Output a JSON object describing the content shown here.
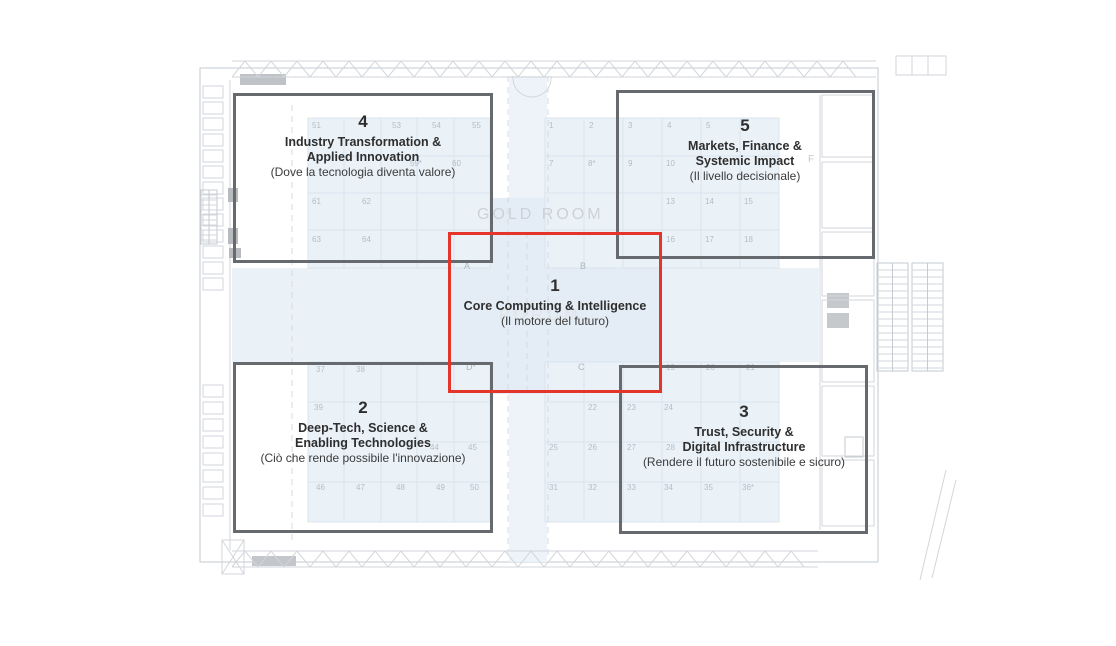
{
  "diagram_title": "Exhibition floor plan with thematic zones",
  "colors": {
    "zone_outline": "#66696d",
    "highlight_outline": "#e5352b",
    "booth_fill": "#eaf2f8",
    "corridor_fill": "#eaf1f7",
    "plan_line": "#d2d6db"
  },
  "zones": [
    {
      "number": "1",
      "line1": "Core Computing & Intelligence",
      "line2": "",
      "subtitle": "(Il motore del futuro)",
      "highlighted": true
    },
    {
      "number": "2",
      "line1": "Deep-Tech, Science &",
      "line2": "Enabling Technologies",
      "subtitle": "(Ciò che rende possibile l'innovazione)",
      "highlighted": false
    },
    {
      "number": "3",
      "line1": "Trust, Security &",
      "line2": "Digital Infrastructure",
      "subtitle": "(Rendere il futuro sostenibile e sicuro)",
      "highlighted": false
    },
    {
      "number": "4",
      "line1": "Industry Transformation &",
      "line2": "Applied Innovation",
      "subtitle": "(Dove la tecnologia diventa valore)",
      "highlighted": false
    },
    {
      "number": "5",
      "line1": "Markets, Finance &",
      "line2": "Systemic Impact",
      "subtitle": "(Il livello decisionale)",
      "highlighted": false
    }
  ],
  "plan": {
    "room_label": "GOLD ROOM",
    "forum_label": "FORUM",
    "area_label": "F",
    "hall_letters": [
      {
        "t": "A",
        "x": 464,
        "y": 262
      },
      {
        "t": "B",
        "x": 580,
        "y": 262
      },
      {
        "t": "D*",
        "x": 466,
        "y": 363
      },
      {
        "t": "C",
        "x": 578,
        "y": 363
      }
    ],
    "booth_numbers": [
      {
        "t": "51",
        "x": 312,
        "y": 122
      },
      {
        "t": "53",
        "x": 392,
        "y": 122
      },
      {
        "t": "54",
        "x": 432,
        "y": 122
      },
      {
        "t": "55",
        "x": 472,
        "y": 122
      },
      {
        "t": "59*",
        "x": 410,
        "y": 160
      },
      {
        "t": "60",
        "x": 452,
        "y": 160
      },
      {
        "t": "61",
        "x": 312,
        "y": 198
      },
      {
        "t": "62",
        "x": 362,
        "y": 198
      },
      {
        "t": "63",
        "x": 312,
        "y": 236
      },
      {
        "t": "64",
        "x": 362,
        "y": 236
      },
      {
        "t": "1",
        "x": 549,
        "y": 122
      },
      {
        "t": "2",
        "x": 589,
        "y": 122
      },
      {
        "t": "3",
        "x": 628,
        "y": 122
      },
      {
        "t": "4",
        "x": 667,
        "y": 122
      },
      {
        "t": "5",
        "x": 706,
        "y": 122
      },
      {
        "t": "7",
        "x": 549,
        "y": 160
      },
      {
        "t": "8*",
        "x": 588,
        "y": 160
      },
      {
        "t": "9",
        "x": 628,
        "y": 160
      },
      {
        "t": "10",
        "x": 666,
        "y": 160
      },
      {
        "t": "13",
        "x": 666,
        "y": 198
      },
      {
        "t": "14",
        "x": 705,
        "y": 198
      },
      {
        "t": "15",
        "x": 744,
        "y": 198
      },
      {
        "t": "16",
        "x": 666,
        "y": 236
      },
      {
        "t": "17",
        "x": 705,
        "y": 236
      },
      {
        "t": "18",
        "x": 744,
        "y": 236
      },
      {
        "t": "37",
        "x": 316,
        "y": 366
      },
      {
        "t": "38",
        "x": 356,
        "y": 366
      },
      {
        "t": "39",
        "x": 314,
        "y": 404
      },
      {
        "t": "44",
        "x": 430,
        "y": 444
      },
      {
        "t": "45",
        "x": 468,
        "y": 444
      },
      {
        "t": "46",
        "x": 316,
        "y": 484
      },
      {
        "t": "47",
        "x": 356,
        "y": 484
      },
      {
        "t": "48",
        "x": 396,
        "y": 484
      },
      {
        "t": "49",
        "x": 436,
        "y": 484
      },
      {
        "t": "50",
        "x": 470,
        "y": 484
      },
      {
        "t": "19",
        "x": 666,
        "y": 364
      },
      {
        "t": "20",
        "x": 706,
        "y": 364
      },
      {
        "t": "21",
        "x": 746,
        "y": 364
      },
      {
        "t": "22",
        "x": 588,
        "y": 404
      },
      {
        "t": "23",
        "x": 627,
        "y": 404
      },
      {
        "t": "24",
        "x": 664,
        "y": 404
      },
      {
        "t": "25",
        "x": 549,
        "y": 444
      },
      {
        "t": "26",
        "x": 588,
        "y": 444
      },
      {
        "t": "27",
        "x": 627,
        "y": 444
      },
      {
        "t": "28",
        "x": 666,
        "y": 444
      },
      {
        "t": "31",
        "x": 549,
        "y": 484
      },
      {
        "t": "32",
        "x": 588,
        "y": 484
      },
      {
        "t": "33",
        "x": 627,
        "y": 484
      },
      {
        "t": "34",
        "x": 664,
        "y": 484
      },
      {
        "t": "35",
        "x": 704,
        "y": 484
      },
      {
        "t": "36*",
        "x": 742,
        "y": 484
      }
    ]
  }
}
